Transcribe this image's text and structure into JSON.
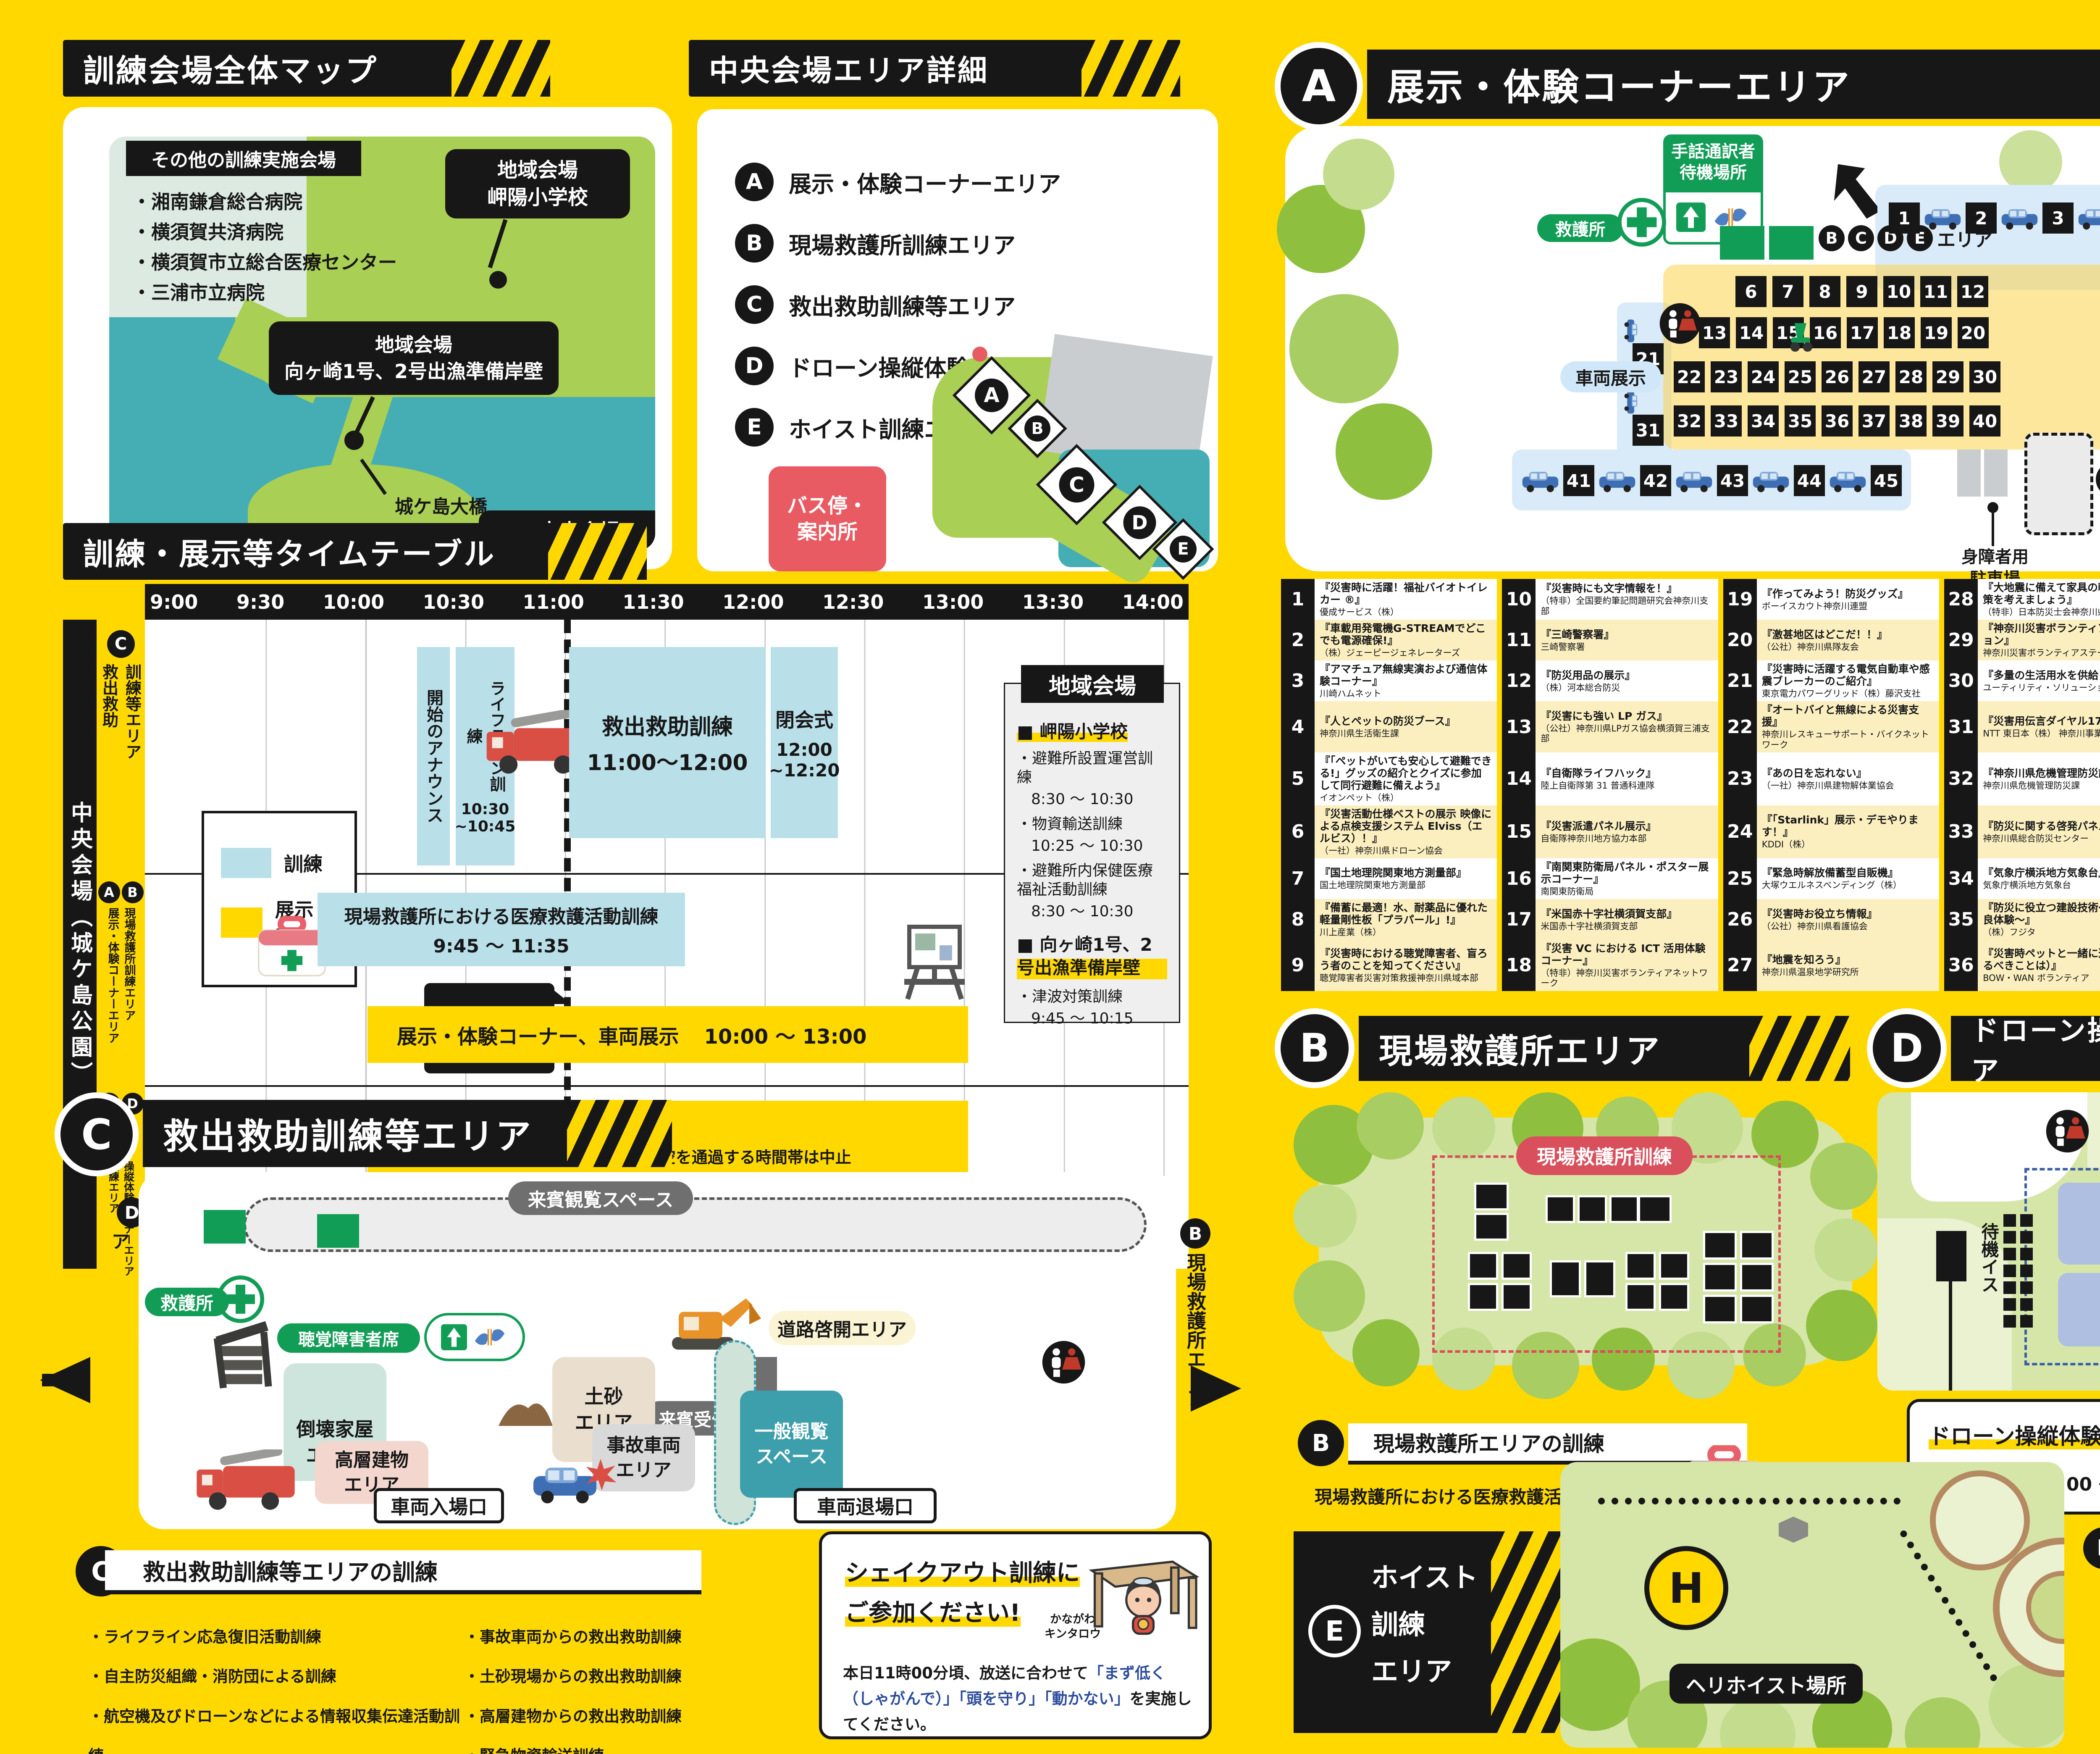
{
  "colors": {
    "bg": "#FFD800",
    "black": "#171717",
    "train_blue": "#B9DFE9",
    "exhibit_yellow": "#FFD800",
    "red": "#E95B63",
    "green": "#129D57",
    "teal": "#45AEB5",
    "land": "#A9CF54"
  },
  "overall_map": {
    "title": "訓練会場全体マップ",
    "other_title": "その他の訓練実施会場",
    "other_venues": [
      "・湘南鎌倉総合病院",
      "・横須賀共済病院",
      "・横須賀市立総合医療センター",
      "・三浦市立病院"
    ],
    "callout_school_l1": "地域会場",
    "callout_school_l2": "岬陽小学校",
    "callout_wharf_l1": "地域会場",
    "callout_wharf_l2": "向ヶ崎1号、2号出漁準備岸壁",
    "bridge_label": "城ケ島大橋",
    "island_label": "城ヶ島",
    "callout_central_l1": "中央会場",
    "callout_central_l2": "県立城ケ島公園"
  },
  "central_detail": {
    "title": "中央会場エリア詳細",
    "legend": [
      {
        "k": "A",
        "label": "展示・体験コーナーエリア"
      },
      {
        "k": "B",
        "label": "現場救護所訓練エリア"
      },
      {
        "k": "C",
        "label": "救出救助訓練等エリア"
      },
      {
        "k": "D",
        "label": "ドローン操縦体験コーナーエリア"
      },
      {
        "k": "E",
        "label": "ホイスト訓練エリア"
      }
    ],
    "bus_l1": "バス停・",
    "bus_l2": "案内所",
    "marks": [
      "A",
      "B",
      "C",
      "D",
      "E"
    ]
  },
  "area_a": {
    "letter": "A",
    "title": "展示・体験コーナーエリア",
    "sign_l1": "手話通訳者",
    "sign_l2": "待機場所",
    "aid": "救護所",
    "vehicle": "車両展示",
    "bcde_letters": [
      "B",
      "C",
      "D",
      "E"
    ],
    "bcde_suffix": "エリア",
    "bus_stop": "バス停・案内所",
    "bicycle": "駐輪場",
    "disabled_l1": "身障者用",
    "disabled_l2": "駐車場",
    "rows": {
      "r1": [
        "1",
        "2",
        "3",
        "4",
        "5"
      ],
      "r2": [
        "6",
        "7",
        "8",
        "9",
        "10",
        "11",
        "12"
      ],
      "r3": [
        "13",
        "14",
        "15",
        "16",
        "17",
        "18",
        "19",
        "20"
      ],
      "r4": [
        "22",
        "23",
        "24",
        "25",
        "26",
        "27",
        "28",
        "29",
        "30"
      ],
      "r5": [
        "32",
        "33",
        "34",
        "35",
        "36",
        "37",
        "38",
        "39",
        "40"
      ],
      "r6": [
        "41",
        "42",
        "43",
        "44",
        "45"
      ],
      "v1": "21",
      "v2": "31"
    }
  },
  "exhibitors": [
    {
      "no": "1",
      "title": "『災害時に活躍！福祉バイオトイレカー ®』",
      "org": "優成サービス（株）"
    },
    {
      "no": "2",
      "title": "『車載用発電機G-STREAMでどこでも電源確保!』",
      "org": "（株）ジェーピージェネレーターズ"
    },
    {
      "no": "3",
      "title": "『アマチュア無線実演および通信体験コーナー』",
      "org": "川崎ハムネット"
    },
    {
      "no": "4",
      "title": "『人とペットの防災ブース』",
      "org": "神奈川県生活衛生課"
    },
    {
      "no": "5",
      "title": "『「ペットがいても安心して避難できる!」グッズの紹介とクイズに参加して同行避難に備えよう』",
      "org": "イオンペット（株）"
    },
    {
      "no": "6",
      "title": "『災害活動仕様ベストの展示 映像による点検支援システム Elviss（エルビス）！』",
      "org": "（一社）神奈川県ドローン協会"
    },
    {
      "no": "7",
      "title": "『国土地理院関東地方測量部』",
      "org": "国土地理院関東地方測量部"
    },
    {
      "no": "8",
      "title": "『備蓄に最適！水、耐薬品に優れた軽量剛性板「プラパール」!』",
      "org": "川上産業（株）"
    },
    {
      "no": "9",
      "title": "『災害時における聴覚障害者、盲ろう者のことを知ってください』",
      "org": "聴覚障害者災害対策救援神奈川県域本部"
    },
    {
      "no": "10",
      "title": "『災害時にも文字情報を！』",
      "org": "（特非）全国要約筆記問題研究会神奈川支部"
    },
    {
      "no": "11",
      "title": "『三崎警察署』",
      "org": "三崎警察署"
    },
    {
      "no": "12",
      "title": "『防災用品の展示』",
      "org": "（株）河本総合防災"
    },
    {
      "no": "13",
      "title": "『災害にも強い LP ガス』",
      "org": "（公社）神奈川県LPガス協会横須賀三浦支部"
    },
    {
      "no": "14",
      "title": "『自衛隊ライフハック』",
      "org": "陸上自衛隊第 31 普通科連隊"
    },
    {
      "no": "15",
      "title": "『災害派遣パネル展示』",
      "org": "自衛隊神奈川地方協力本部"
    },
    {
      "no": "16",
      "title": "『南関東防衛局パネル・ポスター展示コーナー』",
      "org": "南関東防衛局"
    },
    {
      "no": "17",
      "title": "『米国赤十字社横須賀支部』",
      "org": "米国赤十字社横須賀支部"
    },
    {
      "no": "18",
      "title": "『災害 VC における ICT 活用体験コーナー』",
      "org": "（特非）神奈川災害ボランティアネットワーク"
    },
    {
      "no": "19",
      "title": "『作ってみよう！防災グッズ』",
      "org": "ボーイスカウト神奈川連盟"
    },
    {
      "no": "20",
      "title": "『激甚地区はどこだ！！』",
      "org": "（公社）神奈川県隊友会"
    },
    {
      "no": "21",
      "title": "『災害時に活躍する電気自動車や感震ブレーカーのご紹介』",
      "org": "東京電力パワーグリッド（株）藤沢支社"
    },
    {
      "no": "22",
      "title": "『オートバイと無線による災害支援』",
      "org": "神奈川レスキューサポート・バイクネットワーク"
    },
    {
      "no": "23",
      "title": "『あの日を忘れない』",
      "org": "（一社）神奈川県建物解体業協会"
    },
    {
      "no": "24",
      "title": "『「Starlink」展示・デモやります！』",
      "org": "KDDI（株）"
    },
    {
      "no": "25",
      "title": "『緊急時解放備蓄型自販機』",
      "org": "大塚ウエルネスベンディング（株）"
    },
    {
      "no": "26",
      "title": "『災害時お役立ち情報』",
      "org": "（公社）神奈川県看護協会"
    },
    {
      "no": "27",
      "title": "『地震を知ろう』",
      "org": "神奈川県温泉地学研究所"
    },
    {
      "no": "28",
      "title": "『大地震に備えて家具の転倒防止対策を考えましょう』",
      "org": "（特非）日本防災士会神奈川県支部"
    },
    {
      "no": "29",
      "title": "『神奈川災害ボランティアステーション』",
      "org": "神奈川災害ボランティアステーション"
    },
    {
      "no": "30",
      "title": "『多量の生活用水を供給します』",
      "org": "ユーティリティ・ソリューションズ"
    },
    {
      "no": "31",
      "title": "『災害用伝言ダイヤル171体験』",
      "org": "NTT 東日本（株） 神奈川事業部"
    },
    {
      "no": "32",
      "title": "『神奈川県危機管理防災課』",
      "org": "神奈川県危機管理防災課"
    },
    {
      "no": "33",
      "title": "『防災に関する啓発パネル』",
      "org": "神奈川県総合防災センター"
    },
    {
      "no": "34",
      "title": "『気象庁横浜地方気象台』",
      "org": "気象庁横浜地方気象台"
    },
    {
      "no": "35",
      "title": "『防災に役立つ建設技術〜ヘドロ改良体験〜』",
      "org": "（株）フジタ"
    },
    {
      "no": "36",
      "title": "『災害時ペットと一緒に避難（今やるべきことは）』",
      "org": "BOW・WAN ボランティア"
    },
    {
      "no": "37",
      "title": "『ALSOK防犯・防災対策』",
      "org": "ALSOK（株）"
    },
    {
      "no": "38",
      "title": "『楽しく「知って」きちんと「そなえ」よう！』",
      "org": "そなえるネットワークみうら"
    },
    {
      "no": "39",
      "title": "『都市ガスの防災対策について』",
      "org": "神奈川県ガス協会"
    },
    {
      "no": "40",
      "title": "『排便の臭いを一瞬で解決！』",
      "org": "（株）バイオステラ"
    },
    {
      "no": "41",
      "title": "『ソフトバンクの災害対策 / 災害用伝言板サービス体験』",
      "org": "ソフトバンク（株）"
    },
    {
      "no": "42",
      "title": "『100 年人生の、清潔と安心を支える。』",
      "org": "（株）柴橋商会"
    },
    {
      "no": "43",
      "title": "『ドコモの災害対策の取り組み』",
      "org": "NTTドコモ"
    },
    {
      "no": "44",
      "title": "『楽天モバイルの災害への取り組み』",
      "org": "楽天モバイル（株）"
    },
    {
      "no": "45",
      "title": "『食べることは生きること〜非常食 美味しく食べて備蓄しよう！〜』",
      "org": "（公社）神奈川県栄養士会"
    }
  ],
  "timetable": {
    "title": "訓練・展示等タイムテーブル",
    "times": [
      "9:00",
      "9:30",
      "10:00",
      "10:30",
      "11:00",
      "11:30",
      "12:00",
      "12:30",
      "13:00",
      "13:30",
      "14:00"
    ],
    "venue": "中央会場（城ケ島公園）",
    "legend_train": "訓練",
    "legend_exhibit": "展示・体験",
    "row1_letter": "C",
    "row1_l1": "救出救助",
    "row1_l2": "訓練等エリア",
    "row2_a": "A",
    "row2_a_label": "展示・体験コーナーエリア",
    "row2_b": "B",
    "row2_b_label": "現場救護所訓練エリア",
    "row3_e": "E",
    "row3_e_label": "ホイスト訓練エリア",
    "row3_d": "D",
    "row3_d_label": "ドローン操縦体験コーナーエリア",
    "announce": "開始のアナウンス",
    "lifeline_l1": "ライフライン訓練",
    "lifeline_time1": "10:30",
    "lifeline_time2": "~10:45",
    "rescue": "救出救助訓練",
    "rescue_time": "11:00〜12:00",
    "closing": "閉会式",
    "closing_time1": "12:00",
    "closing_time2": "~12:20",
    "medical": "現場救護所における医療救護活動訓練",
    "medical_time": "9:45 〜 11:35",
    "shakeout_l1": "シェイクアウト",
    "shakeout_l2": "訓練",
    "exhibit": "展示・体験コーナー、車両展示",
    "exhibit_time": "10:00 〜 13:00",
    "drone": "ドローン操縦体験コーナー",
    "drone_time": "10:00 〜 13:00",
    "drone_note": "※航空機が上空を通過する時間帯は中止",
    "hoist": "ホイスト訓練",
    "hoist_time": "11:39 ~12:00",
    "regional_title": "地域会場",
    "school_head": "■ 岬陽小学校",
    "school_items": [
      {
        "n": "・避難所設置運営訓練",
        "t": "8:30 〜 10:30"
      },
      {
        "n": "・物資輸送訓練",
        "t": "10:25 〜 10:30"
      },
      {
        "n": "・避難所内保健医療福祉活動訓練",
        "t": "8:30 〜 10:30"
      }
    ],
    "wharf_head": "■ 向ヶ崎1号、2号出漁準備岸壁",
    "wharf_items": [
      {
        "n": "・津波対策訓練",
        "t": "9:45 〜 10:15"
      }
    ]
  },
  "area_c": {
    "letter": "C",
    "title": "救出救助訓練等エリア",
    "guest_view": "来賓観覧スペース",
    "aid": "救護所",
    "hearing": "聴覚障害者席",
    "road": "道路啓開エリア",
    "guest_tent": "来賓受付テント",
    "collapsed_l1": "倒壊家屋",
    "collapsed_l2": "エリア",
    "soil_l1": "土砂",
    "soil_l2": "エリア",
    "general_l1": "一般観覧",
    "general_l2": "スペース",
    "accident_l1": "事故車両",
    "accident_l2": "エリア",
    "tall_l1": "高層建物",
    "tall_l2": "エリア",
    "entry": "車両入場口",
    "exit": "車両退場口",
    "to_d_letter": "D",
    "to_d": "ドローン操縦体験コーナーエリア",
    "to_b_letter": "B",
    "to_b": "現場救護所エリア",
    "train_title": "救出救助訓練等エリアの訓練",
    "train_left": [
      "・ライフライン応急復旧活動訓練",
      "・自主防災組織・消防団による訓練",
      "・航空機及びドローンなどによる情報収集伝達活動訓練",
      "・道路啓開、緊急交通路確保訓練"
    ],
    "train_right": [
      "・事故車両からの救出救助訓練",
      "・土砂現場からの救出救助訓練",
      "・高層建物からの救出救助訓練",
      "・緊急物資輸送訓練"
    ]
  },
  "shakeout": {
    "title_l1": "シェイクアウト訓練に",
    "title_l2": "ご参加ください!",
    "char_l1": "かながわ",
    "char_l2": "キンタロウ",
    "body_pre": "本日11時00分頃、放送に合わせて",
    "body_q1": "「まず低く（しゃがんで）」",
    "body_q2": "「頭を守り」「動かない」",
    "body_post": "を実施してください。"
  },
  "area_b": {
    "letter": "B",
    "title": "現場救護所エリア",
    "map_label": "現場救護所訓練",
    "train_title": "現場救護所エリアの訓練",
    "train_item": "現場救護所における医療救護活動訓練"
  },
  "area_d": {
    "letter": "D",
    "title": "ドローン操縦体験コーナーエリア",
    "wait_chairs": "待機イス",
    "fly_l1": "ドローン",
    "fly_l2": "飛行エリア",
    "recep_title": "ドローン操縦体験受付はこちら！",
    "recep_time": "受付開始 / 10：00 〜"
  },
  "area_e": {
    "letter": "E",
    "title_l1": "ホイスト",
    "title_l2": "訓練",
    "title_l3": "エリア",
    "h": "H",
    "heli_spot": "ヘリホイスト場所",
    "train_title": "ホイスト訓練エリアの訓練",
    "train_item": "ホイスト救助訓練",
    "note_pre": "※ヘリによるホイスト訓練時、ピクニック広場の",
    "note_red": "城ケ島公園第一展望台への立ち入りはできません。"
  }
}
